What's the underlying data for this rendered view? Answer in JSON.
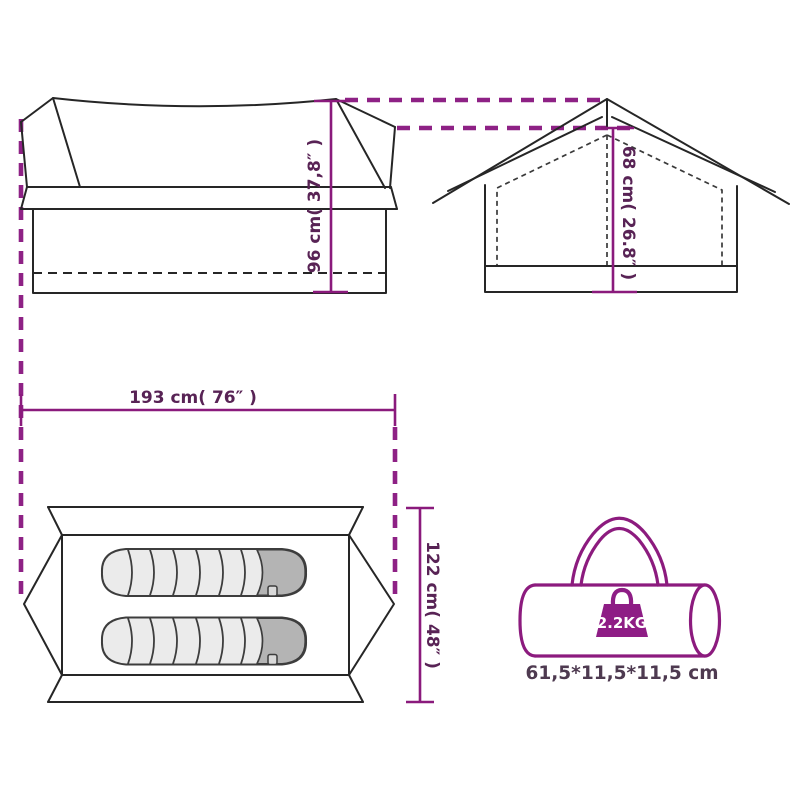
{
  "diagram": {
    "title": "tent-dimensions-diagram",
    "colors": {
      "accent_magenta": "#8a1a7c",
      "projection_dash": "#8e2185",
      "label_text": "#582355",
      "outline_black": "#262626",
      "sleeping_bag_fill": "#ebebeb",
      "sleeping_bag_head": "#b4b4b4",
      "weight_badge_text": "#ffffff"
    },
    "side_view": {
      "height_label": "96 cm( 37,8″ )"
    },
    "front_view": {
      "peak_height_label": "68 cm( 26.8″ )"
    },
    "top_view": {
      "length_label": "193 cm( 76″ )",
      "width_label": "122 cm( 48″ )",
      "sleeping_bag_count": 2
    },
    "carry_bag": {
      "weight_label": "2.2KG",
      "packed_size_label": "61,5*11,5*11,5 cm"
    }
  }
}
